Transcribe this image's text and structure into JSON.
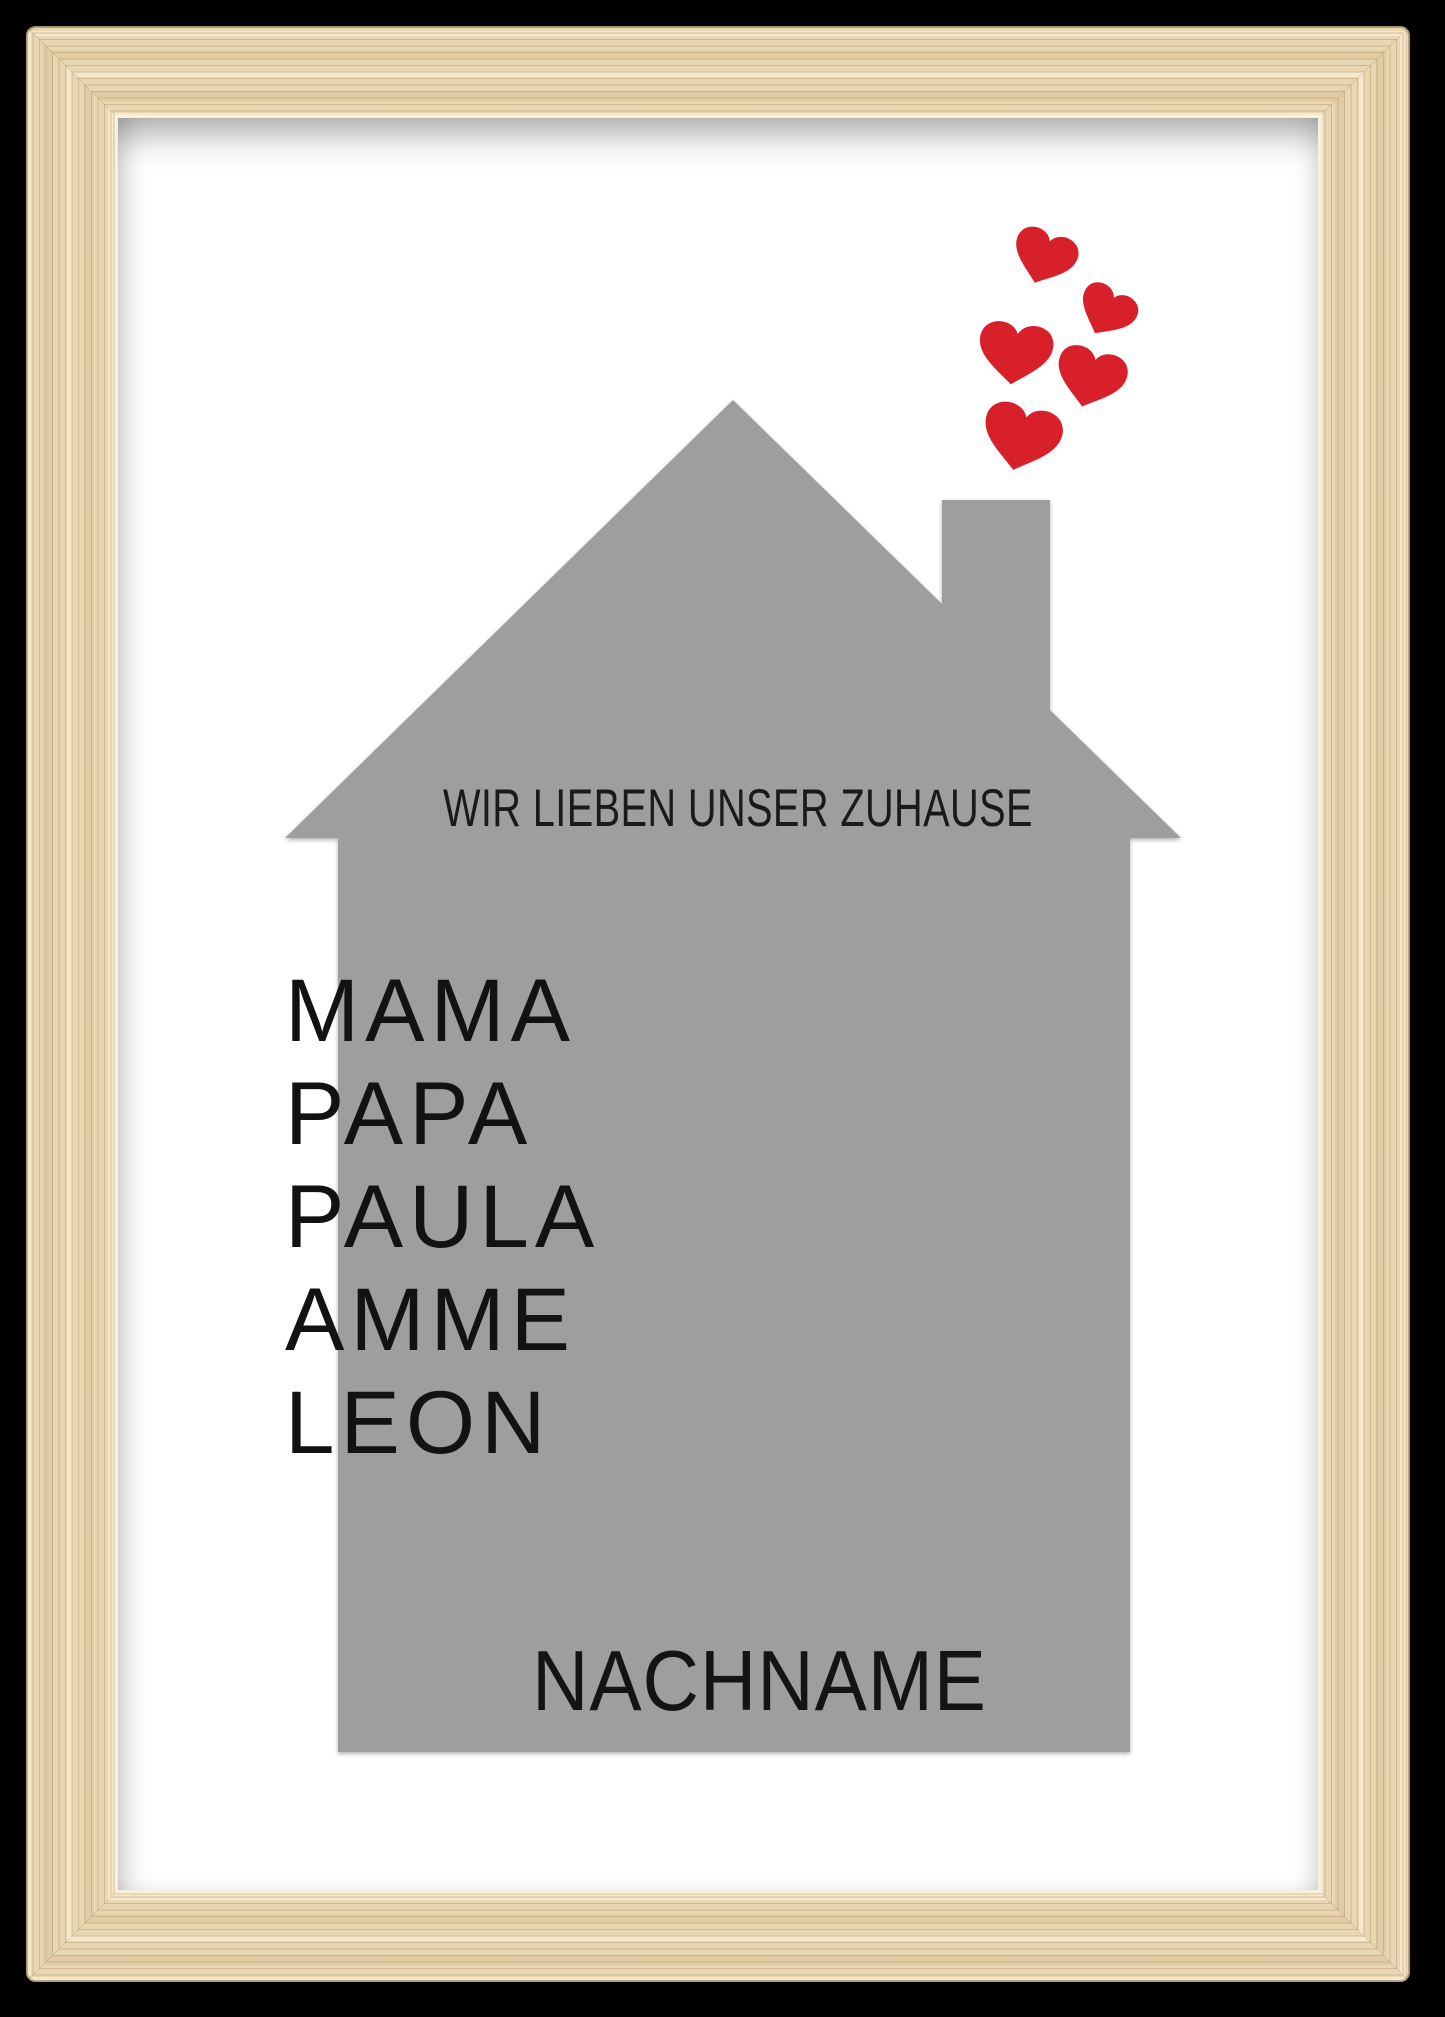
{
  "poster": {
    "title": "WIR LIEBEN UNSER ZUHAUSE",
    "names": [
      "MAMA",
      "PAPA",
      "PAULA",
      "AMME",
      "LEON"
    ],
    "surname": "NACHNAME",
    "hearts_count": 5
  },
  "icons": {
    "heart": "♥"
  },
  "colors": {
    "background": "#000000",
    "frame_wood": "#e9d6b3",
    "mat": "#ffffff",
    "house": "#9e9e9e",
    "heart_red": "#d8202a",
    "text": "#1a1a1a"
  }
}
